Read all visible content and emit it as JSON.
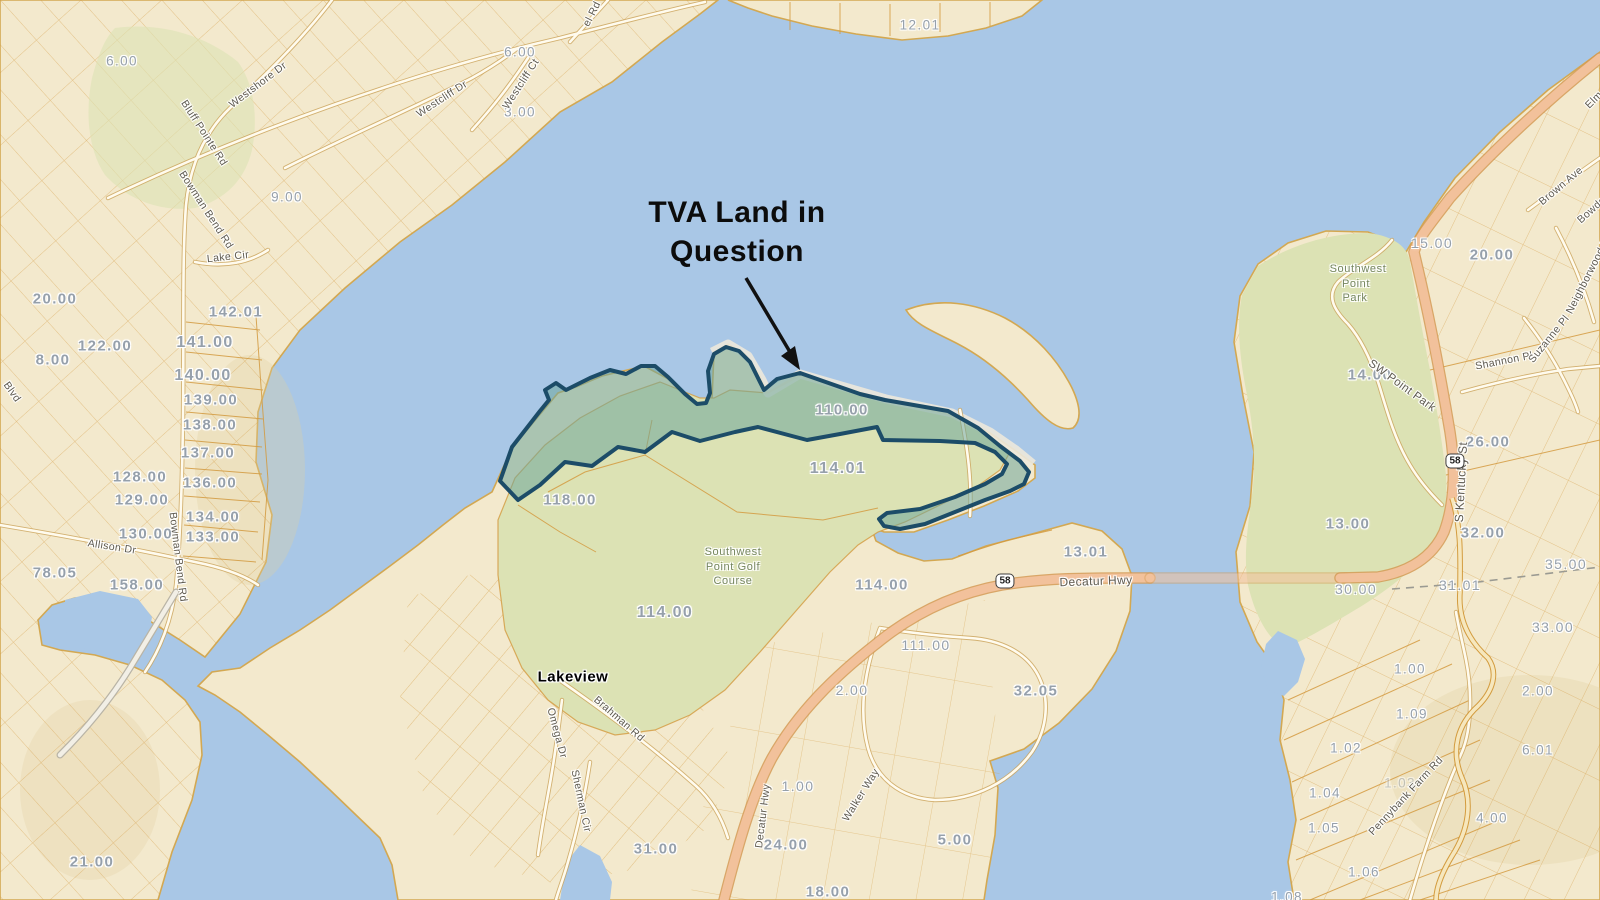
{
  "annotation": {
    "line1": "TVA Land in",
    "line2": "Question"
  },
  "colors": {
    "water": "#a9c7e6",
    "land": "#f3e9cd",
    "park": "#dce2b4",
    "shore": "#d3a852",
    "parcel_line": "#d39a3f",
    "highway": "#f2c19b",
    "number_text": "#96a0ab",
    "tva_fill": "#6ea59b",
    "tva_outline": "#1c4c68"
  },
  "shields": [
    {
      "t": "58",
      "x": 1005,
      "y": 581
    },
    {
      "t": "58",
      "x": 1455,
      "y": 461
    }
  ],
  "parcel_labels": [
    {
      "t": "6.00",
      "x": 122,
      "y": 61
    },
    {
      "t": "9.00",
      "x": 287,
      "y": 197
    },
    {
      "t": "6.00",
      "x": 520,
      "y": 52
    },
    {
      "t": "3.00",
      "x": 520,
      "y": 112
    },
    {
      "t": "12.01",
      "x": 920,
      "y": 25
    },
    {
      "t": "20.00",
      "x": 55,
      "y": 299,
      "s": 15
    },
    {
      "t": "142.01",
      "x": 236,
      "y": 312,
      "s": 15
    },
    {
      "t": "122.00",
      "x": 105,
      "y": 346,
      "s": 15
    },
    {
      "t": "141.00",
      "x": 205,
      "y": 343,
      "s": 16
    },
    {
      "t": "8.00",
      "x": 53,
      "y": 360,
      "s": 15
    },
    {
      "t": "140.00",
      "x": 203,
      "y": 376,
      "s": 16
    },
    {
      "t": "139.00",
      "x": 211,
      "y": 400,
      "s": 15
    },
    {
      "t": "138.00",
      "x": 210,
      "y": 425,
      "s": 15
    },
    {
      "t": "137.00",
      "x": 208,
      "y": 453,
      "s": 15
    },
    {
      "t": "128.00",
      "x": 140,
      "y": 477,
      "s": 15
    },
    {
      "t": "136.00",
      "x": 210,
      "y": 483,
      "s": 15
    },
    {
      "t": "129.00",
      "x": 142,
      "y": 500,
      "s": 15
    },
    {
      "t": "134.00",
      "x": 213,
      "y": 517,
      "s": 15
    },
    {
      "t": "130.00",
      "x": 146,
      "y": 534,
      "s": 15
    },
    {
      "t": "133.00",
      "x": 213,
      "y": 537,
      "s": 15
    },
    {
      "t": "78.05",
      "x": 55,
      "y": 573,
      "s": 15
    },
    {
      "t": "158.00",
      "x": 137,
      "y": 585,
      "s": 15
    },
    {
      "t": "21.00",
      "x": 92,
      "y": 862,
      "s": 15
    },
    {
      "t": "118.00",
      "x": 570,
      "y": 500,
      "s": 15
    },
    {
      "t": "110.00",
      "x": 842,
      "y": 410,
      "s": 15
    },
    {
      "t": "114.01",
      "x": 838,
      "y": 469,
      "s": 16
    },
    {
      "t": "114.00",
      "x": 665,
      "y": 613,
      "s": 16
    },
    {
      "t": "114.00",
      "x": 882,
      "y": 585,
      "s": 15
    },
    {
      "t": "111.00",
      "x": 926,
      "y": 645,
      "s": 14
    },
    {
      "t": "2.00",
      "x": 852,
      "y": 690,
      "s": 14
    },
    {
      "t": "1.00",
      "x": 798,
      "y": 786,
      "s": 14
    },
    {
      "t": "24.00",
      "x": 786,
      "y": 845,
      "s": 15
    },
    {
      "t": "31.00",
      "x": 656,
      "y": 849,
      "s": 15
    },
    {
      "t": "5.00",
      "x": 955,
      "y": 840,
      "s": 15
    },
    {
      "t": "18.00",
      "x": 828,
      "y": 892,
      "s": 15
    },
    {
      "t": "32.05",
      "x": 1036,
      "y": 691,
      "s": 15
    },
    {
      "t": "13.01",
      "x": 1086,
      "y": 552,
      "s": 15
    },
    {
      "t": "15.00",
      "x": 1432,
      "y": 243,
      "s": 14
    },
    {
      "t": "20.00",
      "x": 1492,
      "y": 255,
      "s": 15
    },
    {
      "t": "14.00",
      "x": 1370,
      "y": 375,
      "s": 15
    },
    {
      "t": "26.00",
      "x": 1488,
      "y": 442,
      "s": 15
    },
    {
      "t": "13.00",
      "x": 1348,
      "y": 524,
      "s": 15
    },
    {
      "t": "32.00",
      "x": 1483,
      "y": 533,
      "s": 15
    },
    {
      "t": "30.00",
      "x": 1356,
      "y": 589,
      "s": 14
    },
    {
      "t": "31.01",
      "x": 1460,
      "y": 585,
      "s": 14
    },
    {
      "t": "35.00",
      "x": 1566,
      "y": 564,
      "s": 14
    },
    {
      "t": "33.00",
      "x": 1553,
      "y": 627,
      "s": 14
    },
    {
      "t": "1.00",
      "x": 1410,
      "y": 669
    },
    {
      "t": "2.00",
      "x": 1538,
      "y": 691
    },
    {
      "t": "1.09",
      "x": 1412,
      "y": 714
    },
    {
      "t": "1.02",
      "x": 1346,
      "y": 748
    },
    {
      "t": "6.01",
      "x": 1538,
      "y": 750
    },
    {
      "t": "1.03",
      "x": 1400,
      "y": 783,
      "o": 0.5
    },
    {
      "t": "1.04",
      "x": 1325,
      "y": 793
    },
    {
      "t": "1.05",
      "x": 1324,
      "y": 828
    },
    {
      "t": "4.00",
      "x": 1492,
      "y": 818
    },
    {
      "t": "1.06",
      "x": 1364,
      "y": 872
    },
    {
      "t": "1.08",
      "x": 1287,
      "y": 897
    }
  ],
  "road_labels": [
    {
      "t": "Westshore Dr",
      "x": 258,
      "y": 85,
      "r": -37
    },
    {
      "t": "Westcliff Dr",
      "x": 442,
      "y": 99,
      "r": -33
    },
    {
      "t": "Westcliff Ct",
      "x": 521,
      "y": 84,
      "r": -57
    },
    {
      "t": "el Rd",
      "x": 592,
      "y": 14,
      "r": -63
    },
    {
      "t": "Bluff Pointe Rd",
      "x": 204,
      "y": 133,
      "r": 57
    },
    {
      "t": "Bowman Bend Rd",
      "x": 206,
      "y": 210,
      "r": 57
    },
    {
      "t": "Lake Cir",
      "x": 228,
      "y": 257,
      "r": -6
    },
    {
      "t": "Blvd",
      "x": 12,
      "y": 392,
      "r": 55
    },
    {
      "t": "Allison Dr",
      "x": 112,
      "y": 547,
      "r": 9
    },
    {
      "t": "Bowman Bend Rd",
      "x": 178,
      "y": 557,
      "r": 83
    },
    {
      "t": "Brahman Rd",
      "x": 619,
      "y": 719,
      "r": 41
    },
    {
      "t": "Omega Dr",
      "x": 557,
      "y": 733,
      "r": 75
    },
    {
      "t": "Sherman Cir",
      "x": 581,
      "y": 801,
      "r": 78
    },
    {
      "t": "Decatur Hwy",
      "x": 763,
      "y": 816,
      "r": -83
    },
    {
      "t": "Walker Way",
      "x": 861,
      "y": 795,
      "r": -58
    },
    {
      "t": "Decatur Hwy",
      "x": 1096,
      "y": 581,
      "r": -2,
      "s": 12
    },
    {
      "t": "Pennybank Farm Rd",
      "x": 1406,
      "y": 796,
      "r": -47
    },
    {
      "t": "S Kentucky St",
      "x": 1461,
      "y": 482,
      "r": -87,
      "s": 12
    },
    {
      "t": "SW Point Park",
      "x": 1402,
      "y": 386,
      "r": 36,
      "s": 11.5
    },
    {
      "t": "Shannon Pl",
      "x": 1504,
      "y": 361,
      "r": -11
    },
    {
      "t": "Suzanne Pl",
      "x": 1549,
      "y": 339,
      "r": -51
    },
    {
      "t": "Neighborwood Dr",
      "x": 1589,
      "y": 274,
      "r": -63
    },
    {
      "t": "Brown Ave",
      "x": 1561,
      "y": 186,
      "r": -40
    },
    {
      "t": "Bowden",
      "x": 1594,
      "y": 208,
      "r": -42
    },
    {
      "t": "Elm",
      "x": 1594,
      "y": 100,
      "r": -45
    }
  ],
  "park_labels": [
    {
      "t": "Southwest",
      "x": 1358,
      "y": 269
    },
    {
      "t": "Point",
      "x": 1356,
      "y": 284
    },
    {
      "t": "Park",
      "x": 1355,
      "y": 298
    },
    {
      "t": "Southwest",
      "x": 733,
      "y": 552
    },
    {
      "t": "Point Golf",
      "x": 733,
      "y": 567
    },
    {
      "t": "Course",
      "x": 733,
      "y": 581
    }
  ],
  "place_labels": [
    {
      "t": "Lakeview",
      "x": 573,
      "y": 677
    }
  ]
}
